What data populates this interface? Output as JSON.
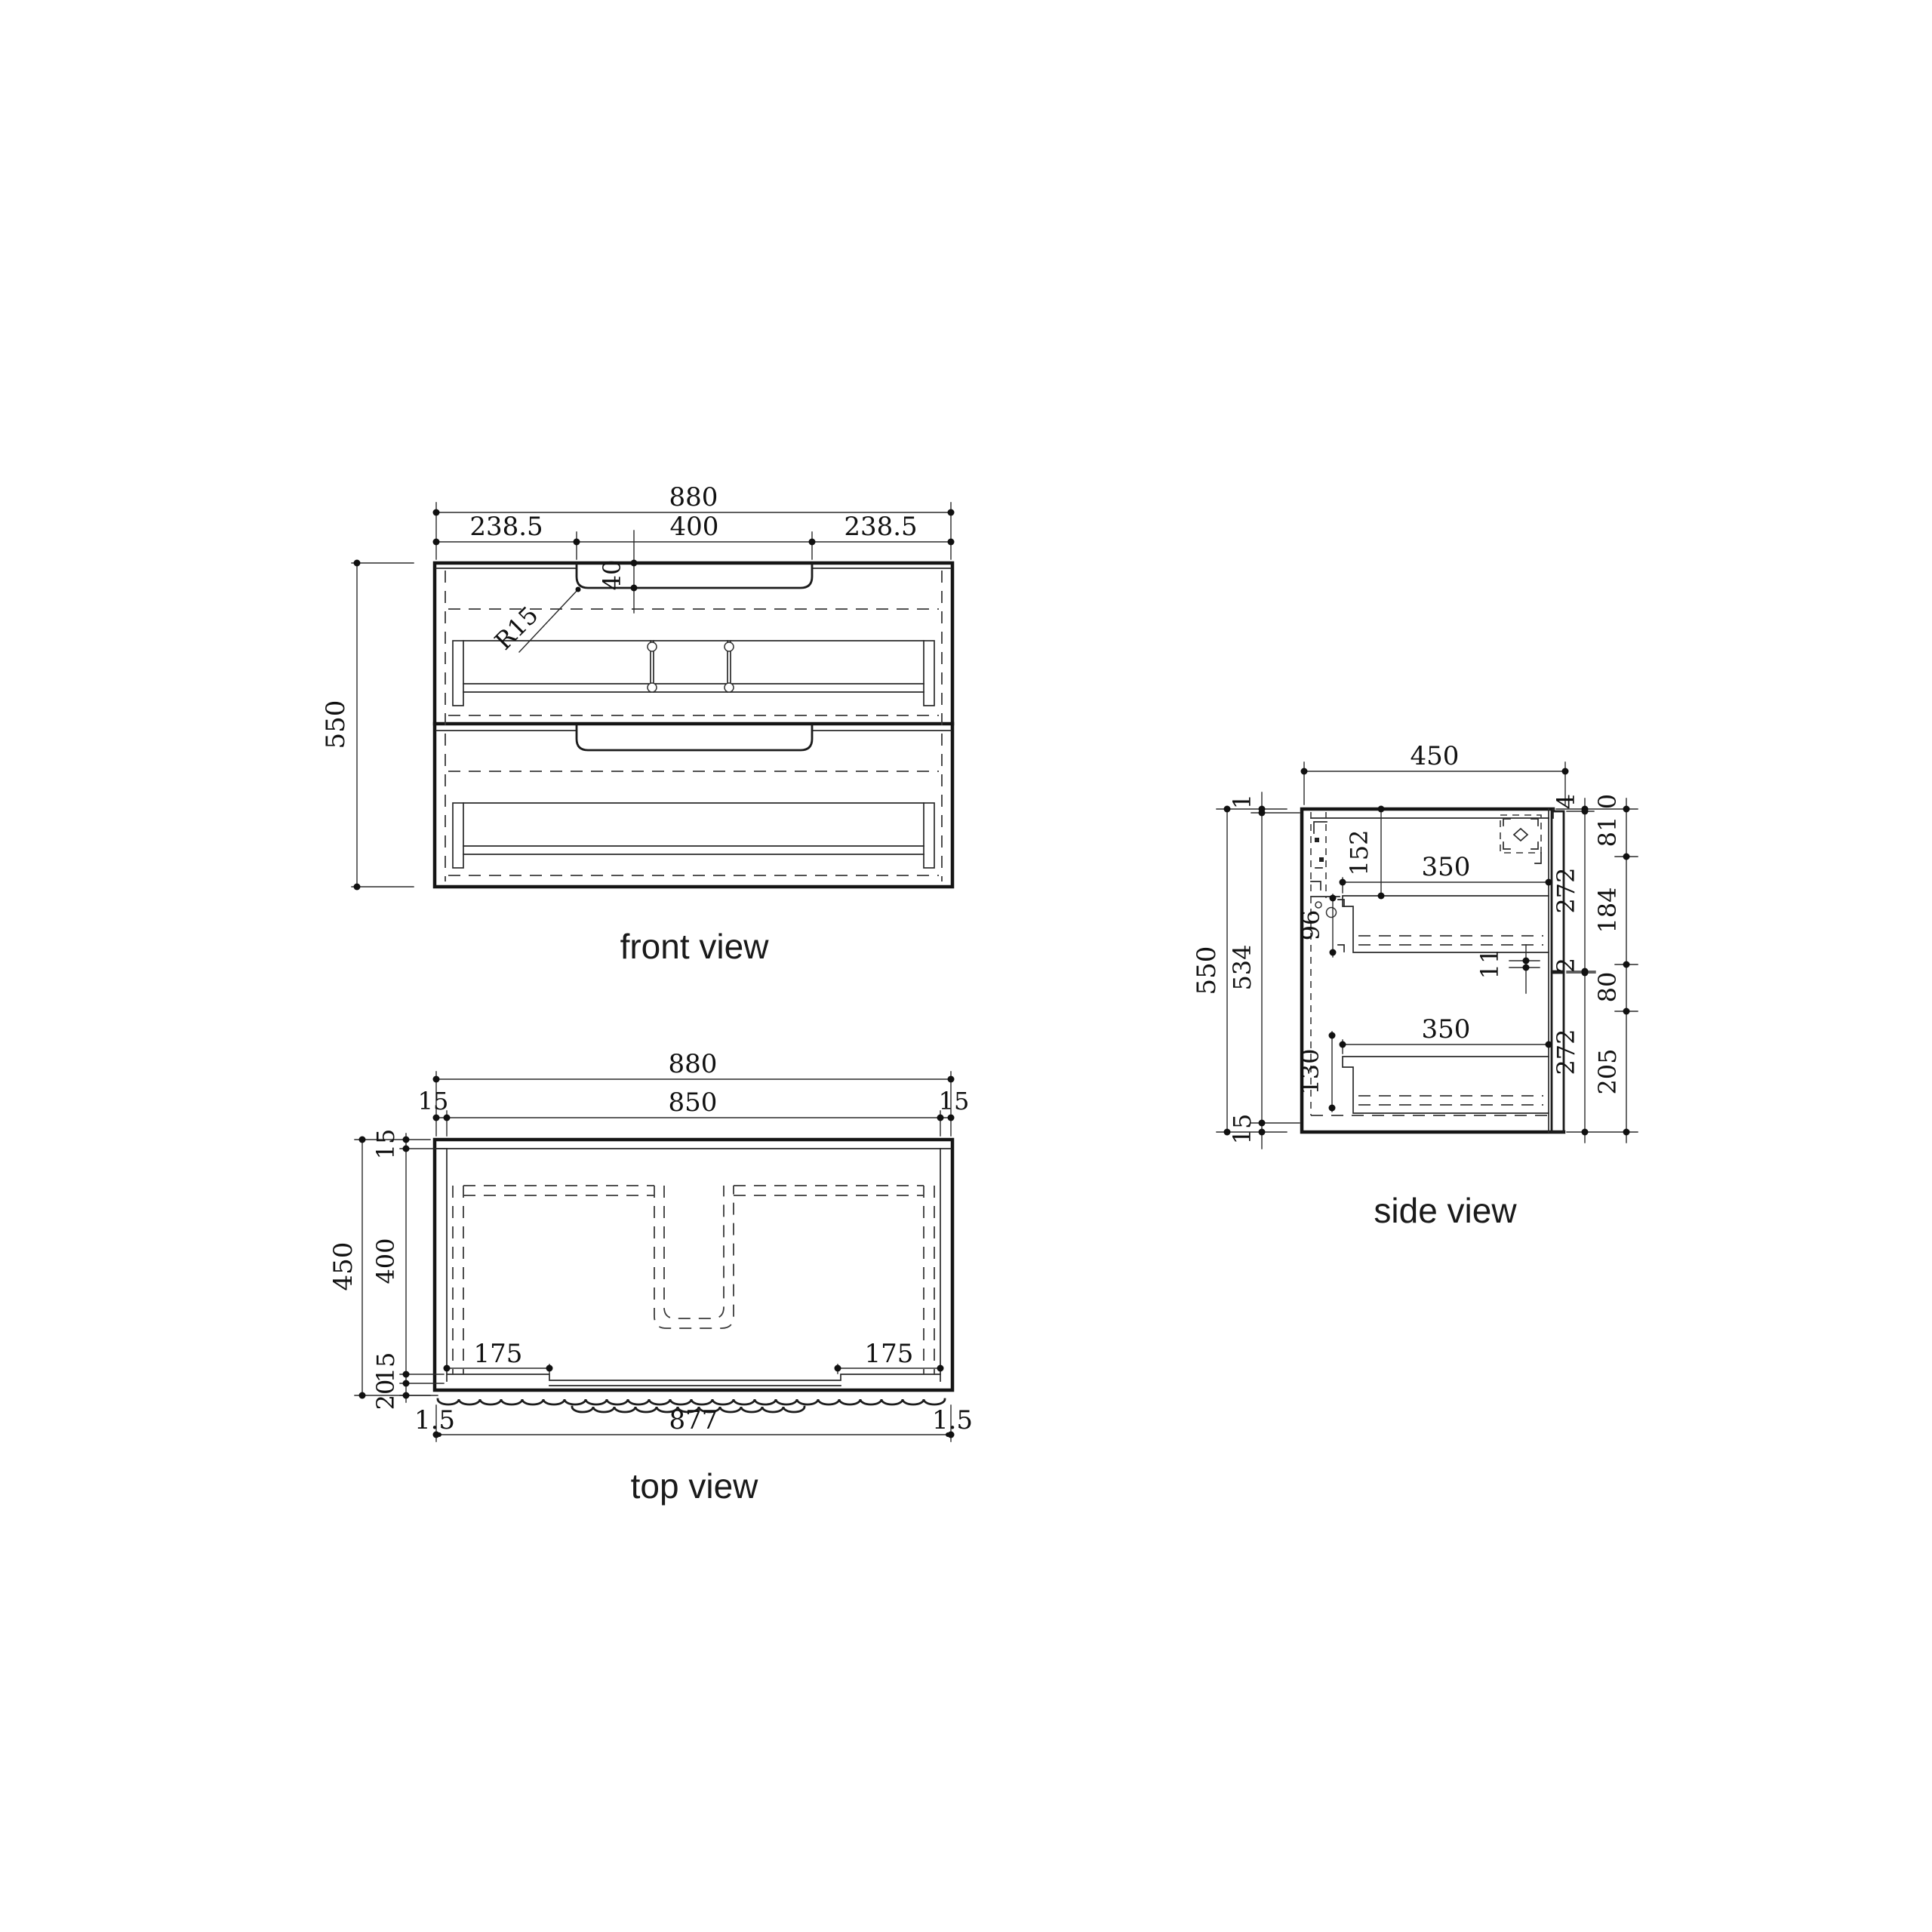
{
  "drawing": {
    "background": "#ffffff",
    "line_color": "#1c1c1c",
    "dim_color": "#222222"
  },
  "front": {
    "label": "front view",
    "dims": {
      "overall_width": "880",
      "left_offset": "238.5",
      "handle_width": "400",
      "right_offset": "238.5",
      "handle_depth": "40",
      "handle_radius": "R15",
      "overall_height": "550"
    }
  },
  "top": {
    "label": "top view",
    "dims": {
      "overall_width": "880",
      "inner_width": "850",
      "inset_left": "15",
      "inset_right": "15",
      "overall_depth": "450",
      "back_panel": "15",
      "inner_depth": "400",
      "front_panel": "15",
      "front_overhang": "20",
      "left_step": "175",
      "right_step": "175",
      "bottom_left": "1.5",
      "bottom_width": "877",
      "bottom_right": "1.5"
    }
  },
  "side": {
    "label": "side view",
    "dims": {
      "overall_depth": "450",
      "overall_height": "550",
      "top_gap": "1",
      "inner_height": "534",
      "bottom_panel": "15",
      "bracket_offset": "152",
      "bracket_height": "96",
      "drawer1_depth": "350",
      "drawer2_depth": "350",
      "runner_offset": "130",
      "clearance": "11",
      "front_top_gap": "4",
      "front1_height": "272",
      "front_gap": "2",
      "front2_height": "272",
      "hole_zero": "0",
      "hole_a": "81",
      "hole_b": "184",
      "hole_c": "80",
      "hole_d": "205"
    }
  }
}
